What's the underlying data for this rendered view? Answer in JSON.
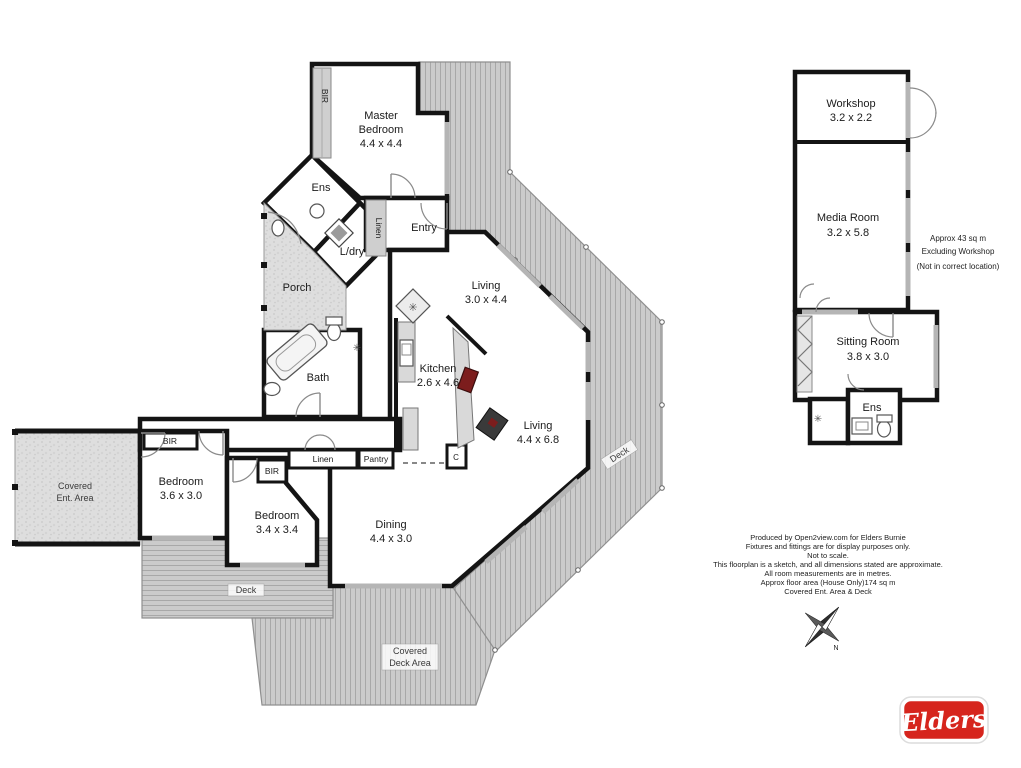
{
  "colors": {
    "wall": "#141414",
    "deck_fill": "#cbcbcb",
    "deck_stripe": "#a6a6a6",
    "window_gray": "#b5b5b5",
    "stove_red": "#7c1d1d",
    "logo_red": "#d6251d"
  },
  "main_house": {
    "rooms": {
      "master": {
        "name_l1": "Master",
        "name_l2": "Bedroom",
        "dims": "4.4 x 4.4"
      },
      "ens": {
        "name": "Ens"
      },
      "ldry": {
        "name": "L/dry"
      },
      "entry": {
        "name": "Entry"
      },
      "porch": {
        "name": "Porch"
      },
      "living1": {
        "name": "Living",
        "dims": "3.0 x 4.4"
      },
      "kitchen": {
        "name": "Kitchen",
        "dims": "2.6 x 4.6"
      },
      "bath": {
        "name": "Bath"
      },
      "living2": {
        "name": "Living",
        "dims": "4.4 x 6.8"
      },
      "dining": {
        "name": "Dining",
        "dims": "4.4 x 3.0"
      },
      "bedroom1": {
        "name": "Bedroom",
        "dims": "3.6 x 3.0"
      },
      "bedroom2": {
        "name": "Bedroom",
        "dims": "3.4 x 3.4"
      }
    },
    "closets": {
      "bir": "BIR",
      "linen": "Linen",
      "pantry": "Pantry",
      "c": "C"
    },
    "outdoor": {
      "covered_ent_l1": "Covered",
      "covered_ent_l2": "Ent. Area",
      "deck": "Deck",
      "covered_deck_l1": "Covered",
      "covered_deck_l2": "Deck Area"
    }
  },
  "outbuilding": {
    "rooms": {
      "workshop": {
        "name": "Workshop",
        "dims": "3.2 x 2.2"
      },
      "media": {
        "name": "Media Room",
        "dims": "3.2 x 5.8"
      },
      "sitting": {
        "name": "Sitting Room",
        "dims": "3.8 x 3.0"
      },
      "ens": {
        "name": "Ens"
      }
    },
    "note": {
      "l1": "Approx 43 sq m",
      "l2": "Excluding Workshop",
      "l3": "(Not in correct location)"
    }
  },
  "disclaimer": {
    "lines": [
      "Produced by Open2view.com for Elders Burnie",
      "Fixtures and fittings are for display purposes only.",
      "Not to scale.",
      "This floorplan is a sketch, and all dimensions stated are approximate.",
      "All room measurements are in metres.",
      "Approx floor area (House Only)174 sq m",
      "Covered Ent. Area & Deck"
    ]
  },
  "compass": {
    "north_label": "N"
  },
  "logo": {
    "brand": "Elders"
  }
}
